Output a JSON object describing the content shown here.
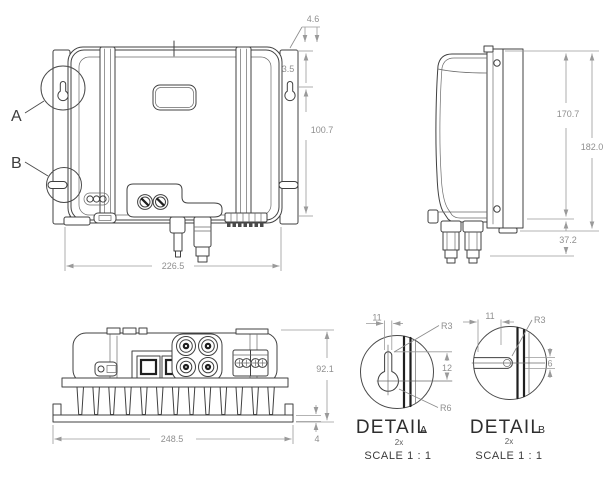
{
  "drawing": {
    "kind": "technical-dimension-drawing",
    "colors": {
      "background": "#ffffff",
      "line": "#404040",
      "dimension": "#9a9a9a",
      "heavy_line": "#1f1f1f"
    }
  },
  "callouts": {
    "a": "A",
    "b": "B"
  },
  "front_view": {
    "dims": {
      "hole_offset": "4.6",
      "top_offset": "3.5",
      "hole_height": "100.7",
      "width": "226.5"
    }
  },
  "side_view": {
    "dims": {
      "body_height": "170.7",
      "total_height": "182.0",
      "connector_depth": "37.2"
    }
  },
  "bottom_view": {
    "dims": {
      "depth": "92.1",
      "base_width": "248.5",
      "flange_thickness": "4"
    }
  },
  "detail_a": {
    "title": "DETAIL",
    "label": "A",
    "qty": "2x",
    "scale": "SCALE 1 : 1",
    "dims": {
      "slot_width": "11",
      "radius_top": "R3",
      "slot_length": "12",
      "radius_bottom": "R6"
    }
  },
  "detail_b": {
    "title": "DETAIL",
    "label": "B",
    "qty": "2x",
    "scale": "SCALE 1 : 1",
    "dims": {
      "slot_width": "11",
      "radius": "R3",
      "slot_height": "6"
    }
  }
}
